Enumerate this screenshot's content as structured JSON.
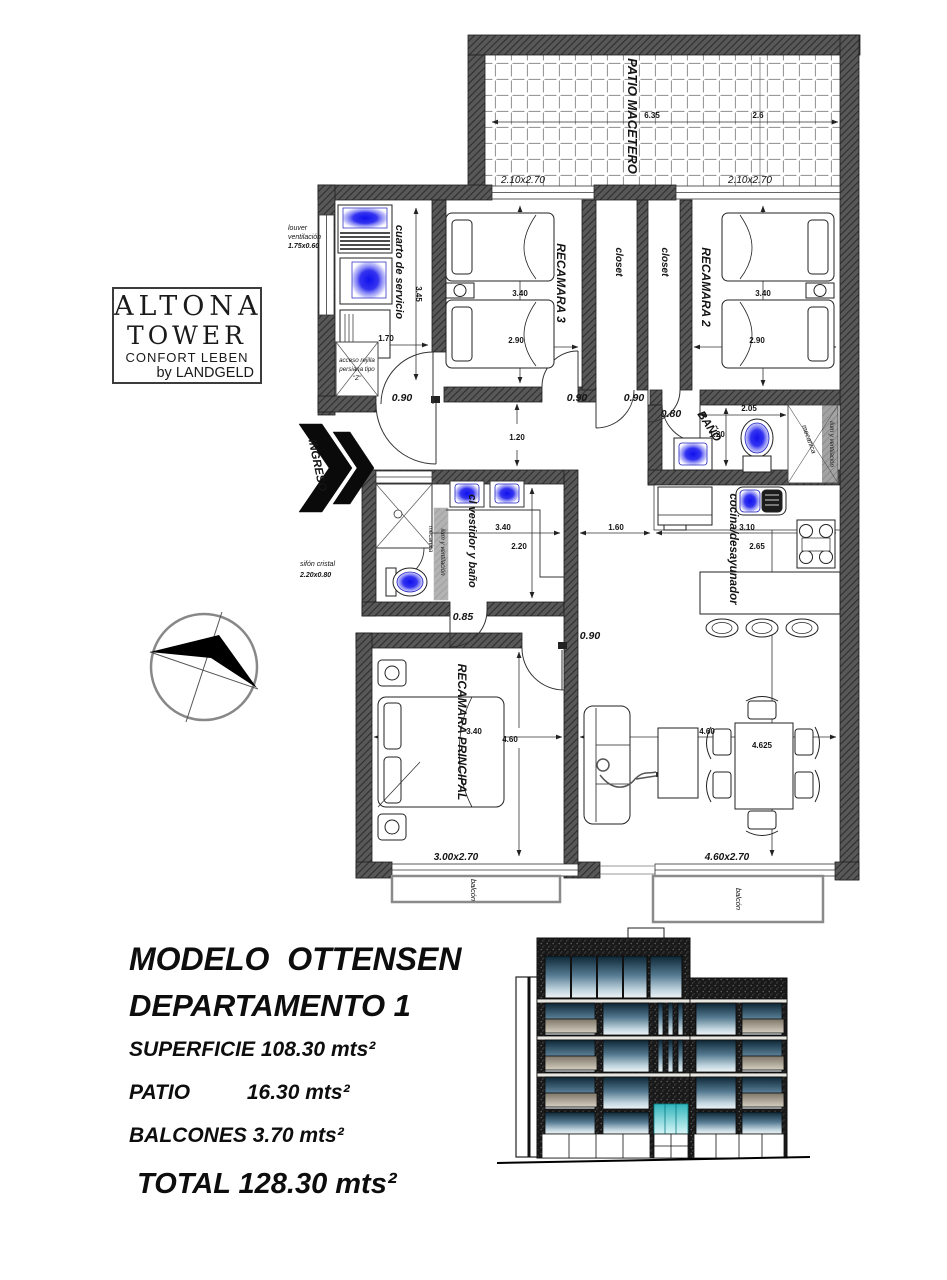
{
  "branding": {
    "name_line1": "ALTONA",
    "name_line2": "TOWER",
    "tagline": "CONFORT LEBEN",
    "byline": "by LANDGELD"
  },
  "plan": {
    "patio": {
      "label": "PATIO MACETERO",
      "dim_a": "6.35",
      "dim_b": "2.6",
      "window_left": "2.10x2.70",
      "window_right": "2.10x2.70"
    },
    "service_room": {
      "label": "cuarto de servicio",
      "dim_depth": "3.45",
      "dim_width": "1.70",
      "door": "0.90",
      "louver_line1": "louver",
      "louver_line2": "ventilación",
      "louver_line3": "1.75x0.60",
      "access_line1": "acceso rejilla",
      "access_line2": "persiana tipo",
      "access_line3": "\"Z\""
    },
    "bedroom3": {
      "label": "RECAMARA 3",
      "dim_depth": "3.40",
      "dim_width": "2.90",
      "door": "0.90"
    },
    "closets": {
      "left": "closet",
      "right": "closet",
      "door": "0.90"
    },
    "bedroom2": {
      "label": "RECAMARA 2",
      "dim_depth": "3.40",
      "dim_width": "2.90"
    },
    "bathroom": {
      "label": "BAÑO",
      "door": "0.80",
      "dim_width": "2.05",
      "dim_depth": "1.20",
      "shaft": "mecanica",
      "vent": "ilum y ventilación"
    },
    "entry": {
      "label": "INGRESO"
    },
    "hall": {
      "dim_width": "1.20",
      "dim_kitchen": "1.60"
    },
    "dressing": {
      "label": "cl vestidor y baño",
      "shaft": "mecanica",
      "vent": "ilum y ventilación",
      "dim_width": "3.40",
      "dim_depth": "2.20",
      "door": "0.85",
      "siphon_line1": "sifón cristal",
      "siphon_line2": "2.20x0.80"
    },
    "kitchen": {
      "label": "cocina/desayunador",
      "dim_width": "3.10",
      "dim_depth": "2.65"
    },
    "master": {
      "label": "RECAMARA PRINCIPAL",
      "dim_width": "3.40",
      "dim_depth": "4.60",
      "door": "0.90",
      "window": "3.00x2.70"
    },
    "living": {
      "dim_width": "4.60",
      "dim_depth": "4.625",
      "window": "4.60x2.70"
    },
    "balcony_left": {
      "label": "balcón"
    },
    "balcony_right": {
      "label": "balcón"
    }
  },
  "summary": {
    "model": "MODELO  OTTENSEN",
    "unit": "DEPARTAMENTO 1",
    "rows": [
      {
        "label": "SUPERFICIE",
        "value": "108.30 mts²"
      },
      {
        "label": "PATIO",
        "value": "16.30 mts²"
      },
      {
        "label": "BALCONES",
        "value": "3.70 mts²"
      }
    ],
    "total_label": "TOTAL",
    "total_value": "128.30 mts²"
  },
  "colors": {
    "wall": "#585858",
    "fixture_glow": "#2020ee",
    "window_glass": "#53788f",
    "entrance_glass": "#2fb3bb"
  }
}
